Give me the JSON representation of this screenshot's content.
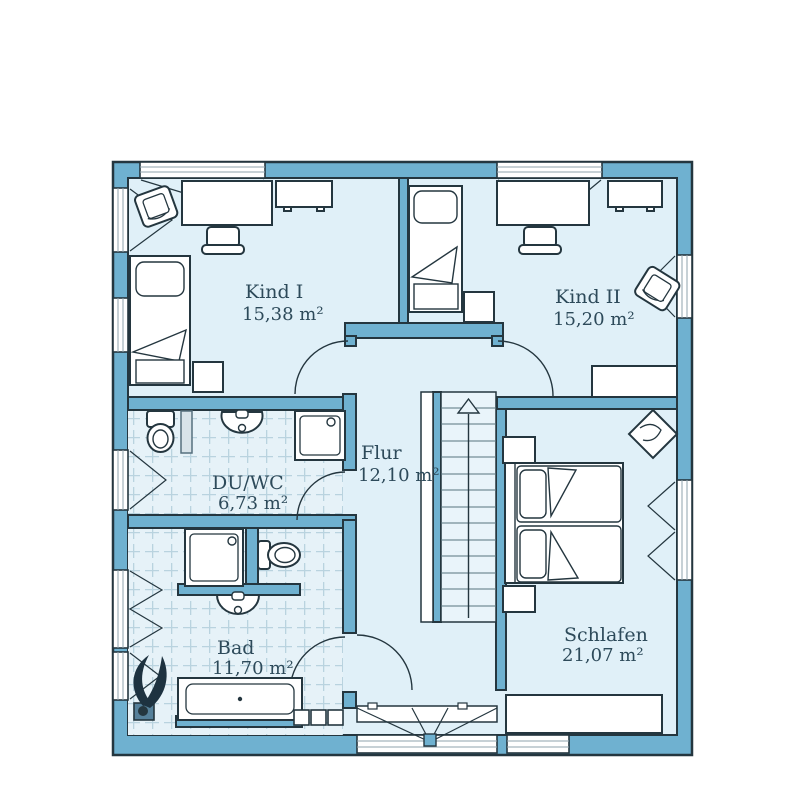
{
  "floorplan": {
    "type": "upper-floor-plan",
    "rooms": [
      {
        "name": "Kind I",
        "area": "15,38 m²"
      },
      {
        "name": "Kind II",
        "area": "15,20 m²"
      },
      {
        "name": "Flur",
        "area": "12,10 m²"
      },
      {
        "name": "DU/WC",
        "area": "6,73 m²"
      },
      {
        "name": "Bad",
        "area": "11,70 m²"
      },
      {
        "name": "Schlafen",
        "area": "21,07 m²"
      }
    ],
    "symbols": [
      "single-bed",
      "double-bed",
      "desk",
      "chair",
      "armchair",
      "sideboard",
      "nightstand",
      "wardrobe-cube",
      "stairs-up-arrow",
      "bathtub",
      "shower",
      "toilet",
      "sink",
      "plant",
      "washing-boxes",
      "floor-drain",
      "door-swing",
      "window"
    ],
    "colors": {
      "wall": "#6fb1d0",
      "floor": "#e0f0f8",
      "outline": "#24363f",
      "tile_line": "#b9d3df",
      "text": "#2d4a5a",
      "window_frame": "#8fa3ad"
    }
  }
}
